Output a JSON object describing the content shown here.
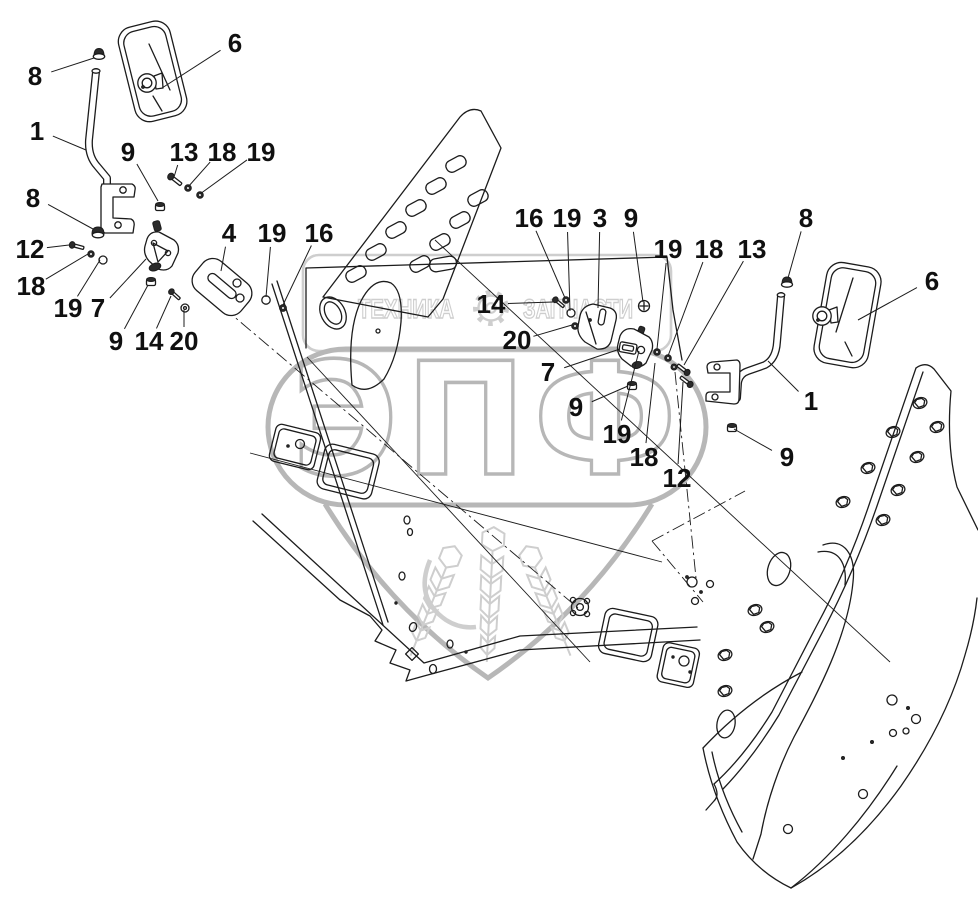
{
  "watermark": {
    "brand_left": "ТЕХНИКА",
    "brand_right": "ЗАПЧАСТИ",
    "logo_text": "ЭПФ"
  },
  "colors": {
    "ink": "#1c1c1c",
    "watermark_main": "#b7b7b7",
    "watermark_light": "#cecece"
  },
  "callouts": [
    {
      "label": "8",
      "x": 35,
      "y": 76,
      "lx": 94,
      "ly": 58
    },
    {
      "label": "6",
      "x": 235,
      "y": 43,
      "lx": 162,
      "ly": 88
    },
    {
      "label": "1",
      "x": 37,
      "y": 131,
      "lx": 86,
      "ly": 150
    },
    {
      "label": "9",
      "x": 128,
      "y": 152,
      "lx": 158,
      "ly": 201
    },
    {
      "label": "13",
      "x": 184,
      "y": 152,
      "lx": 174,
      "ly": 177
    },
    {
      "label": "18",
      "x": 222,
      "y": 152,
      "lx": 188,
      "ly": 187
    },
    {
      "label": "19",
      "x": 261,
      "y": 152,
      "lx": 200,
      "ly": 194
    },
    {
      "label": "8",
      "x": 33,
      "y": 198,
      "lx": 93,
      "ly": 229
    },
    {
      "label": "12",
      "x": 30,
      "y": 249,
      "lx": 69,
      "ly": 245
    },
    {
      "label": "18",
      "x": 31,
      "y": 286,
      "lx": 88,
      "ly": 254
    },
    {
      "label": "19",
      "x": 68,
      "y": 308,
      "lx": 100,
      "ly": 260
    },
    {
      "label": "7",
      "x": 98,
      "y": 308,
      "lx": 146,
      "ly": 259
    },
    {
      "label": "9",
      "x": 116,
      "y": 341,
      "lx": 148,
      "ly": 285
    },
    {
      "label": "14",
      "x": 149,
      "y": 341,
      "lx": 171,
      "ly": 296
    },
    {
      "label": "20",
      "x": 184,
      "y": 341,
      "lx": 184,
      "ly": 310
    },
    {
      "label": "4",
      "x": 229,
      "y": 233,
      "lx": 221,
      "ly": 271
    },
    {
      "label": "19",
      "x": 272,
      "y": 233,
      "lx": 266,
      "ly": 297
    },
    {
      "label": "16",
      "x": 319,
      "y": 233,
      "lx": 283,
      "ly": 305
    },
    {
      "label": "16",
      "x": 529,
      "y": 218,
      "lx": 565,
      "ly": 298
    },
    {
      "label": "19",
      "x": 567,
      "y": 218,
      "lx": 570,
      "ly": 311
    },
    {
      "label": "3",
      "x": 600,
      "y": 218,
      "lx": 598,
      "ly": 308
    },
    {
      "label": "9",
      "x": 631,
      "y": 218,
      "lx": 643,
      "ly": 302
    },
    {
      "label": "19",
      "x": 668,
      "y": 249,
      "lx": 657,
      "ly": 349
    },
    {
      "label": "18",
      "x": 709,
      "y": 249,
      "lx": 668,
      "ly": 356
    },
    {
      "label": "13",
      "x": 752,
      "y": 249,
      "lx": 684,
      "ly": 365
    },
    {
      "label": "8",
      "x": 806,
      "y": 218,
      "lx": 788,
      "ly": 278
    },
    {
      "label": "6",
      "x": 932,
      "y": 281,
      "lx": 858,
      "ly": 320
    },
    {
      "label": "14",
      "x": 491,
      "y": 304,
      "lx": 553,
      "ly": 302
    },
    {
      "label": "20",
      "x": 517,
      "y": 340,
      "lx": 572,
      "ly": 325
    },
    {
      "label": "7",
      "x": 548,
      "y": 372,
      "lx": 620,
      "ly": 349
    },
    {
      "label": "9",
      "x": 576,
      "y": 407,
      "lx": 628,
      "ly": 386
    },
    {
      "label": "19",
      "x": 617,
      "y": 434,
      "lx": 639,
      "ly": 351
    },
    {
      "label": "18",
      "x": 644,
      "y": 457,
      "lx": 655,
      "ly": 363
    },
    {
      "label": "12",
      "x": 677,
      "y": 478,
      "lx": 683,
      "ly": 382
    },
    {
      "label": "1",
      "x": 811,
      "y": 401,
      "lx": 768,
      "ly": 361
    },
    {
      "label": "9",
      "x": 787,
      "y": 457,
      "lx": 734,
      "ly": 429
    }
  ]
}
